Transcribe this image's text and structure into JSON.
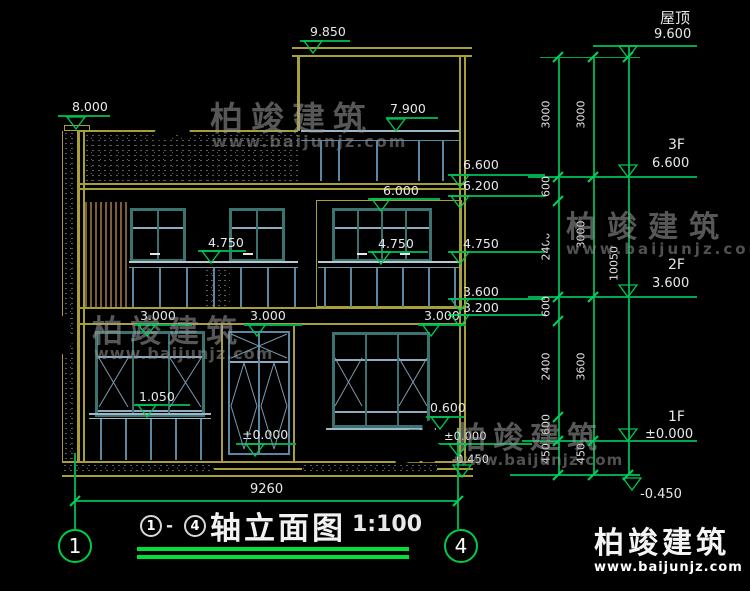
{
  "watermark": {
    "brand": "柏竣建筑",
    "url": "www.baijunjz.com"
  },
  "logo": {
    "brand": "柏竣建筑",
    "url": "www.baijunjz.com"
  },
  "levels": {
    "roof_name": "屋顶",
    "roof_elev": "9.600",
    "f3_name": "3F",
    "f3_elev": "6.600",
    "f2_name": "2F",
    "f2_elev": "3.600",
    "f1_name": "1F",
    "f1_elev": "±0.000",
    "base_elev": "-0.450"
  },
  "markers": {
    "m9850": "9.850",
    "m8000": "8.000",
    "m7900": "7.900",
    "m6600": "6.600",
    "m6200": "6.200",
    "m6000": "6.000",
    "m4750_left": "4.750",
    "m4750_mid": "4.750",
    "m4750_wall": "4.750",
    "m3600": "3.600",
    "m3200": "3.200",
    "m3000_left": "3.000",
    "m3000_door": "3.000",
    "m3000_right": "3.000",
    "m1050": "1.050",
    "m0600": "0.600",
    "m0000_door": "±0.000",
    "m0000_wall": "±0.000",
    "m0450_wall": "-0.450"
  },
  "dims": {
    "inner": [
      "3000",
      "600",
      "2400",
      "600",
      "2400",
      "600",
      "450"
    ],
    "middle": [
      "3000",
      "3000",
      "3600",
      "450"
    ],
    "outer": "10050",
    "width": "9260"
  },
  "axes": {
    "left": "1",
    "right": "4"
  },
  "title": {
    "from": "1",
    "dash": "-",
    "to": "4",
    "text": "轴立面图",
    "scale": "1:100"
  },
  "colors": {
    "background": "#000000",
    "wall_yellow": "#a89f38",
    "dim_green": "#00a94e",
    "bright_green": "#00e036",
    "frame_teal": "#3a7370",
    "mullion_blue": "#7e99ae",
    "louvre_brown": "#7d5f36",
    "text": "#e8e8e8",
    "logo_blue": "#1d66c9",
    "logo_orange": "#f08300"
  }
}
